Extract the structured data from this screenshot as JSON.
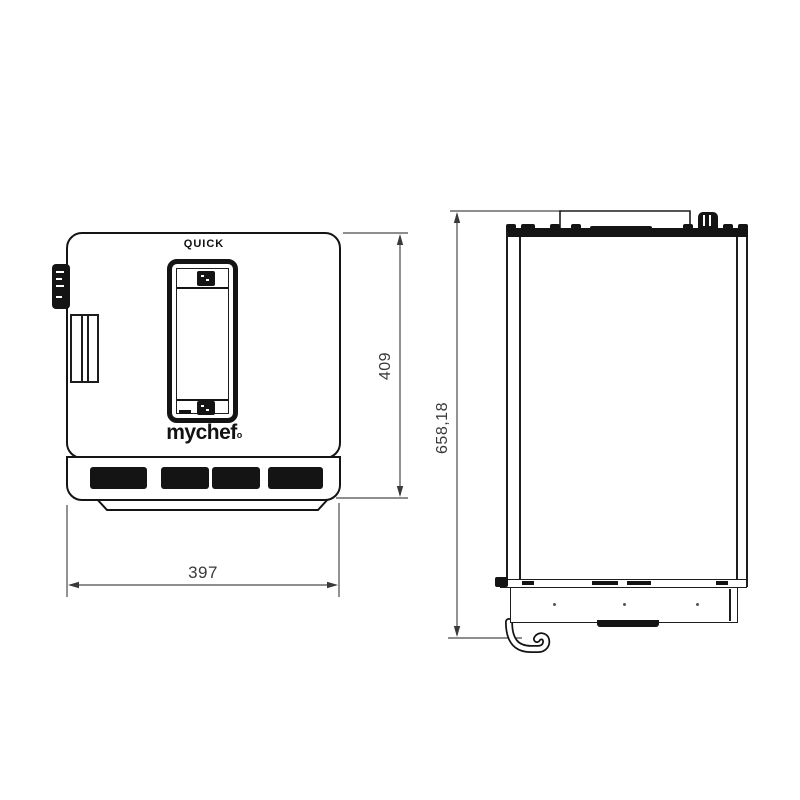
{
  "drawing": {
    "title_label": "QUICK",
    "brand": "mychef",
    "brand_mark": "o",
    "views": {
      "front": "front-elevation",
      "side": "side-elevation"
    },
    "dimensions": {
      "front_width": "397",
      "front_height": "409",
      "side_height": "658,18"
    },
    "colors": {
      "line": "#141414",
      "dimension_line": "#4a4a4a",
      "dimension_text": "#3a3a3a",
      "background": "#ffffff"
    }
  }
}
